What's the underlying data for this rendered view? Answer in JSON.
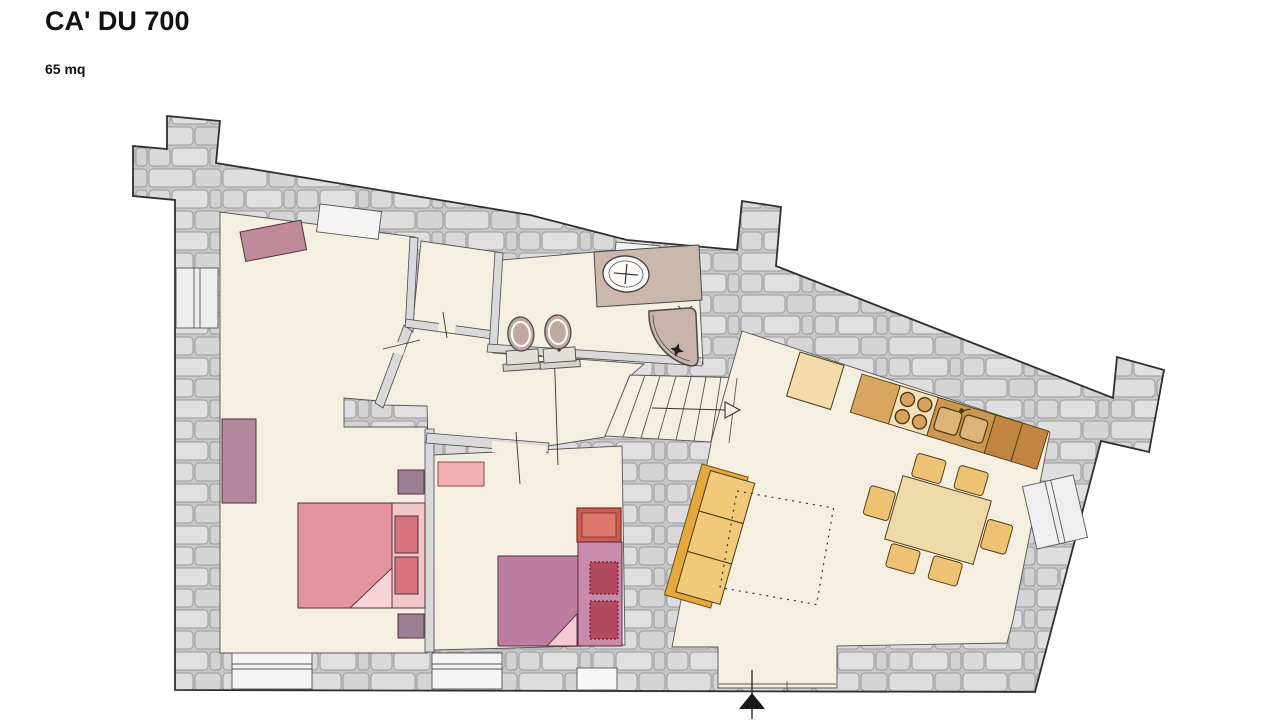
{
  "header": {
    "title": "CA' DU 700",
    "area_label": "65 mq"
  },
  "plan": {
    "rooms": [
      "bedroom-1",
      "closet",
      "bathroom",
      "hallway",
      "stairs",
      "bedroom-2",
      "living-room-kitchen",
      "entrance"
    ],
    "furniture": [
      "double-bed",
      "single-bed-with-trundle",
      "wardrobe",
      "dresser",
      "nightstands",
      "sofa",
      "rug-outline",
      "dining-table-six-chairs",
      "kitchen-counter",
      "stove",
      "double-sink",
      "cabinet",
      "washbasin-vanity",
      "toilet",
      "bidet",
      "corner-shower"
    ],
    "colors": {
      "wall_stone": "#d2d2d2",
      "floor_cream": "#f5efe2",
      "bed_pink": "#e595a0",
      "bed_purple": "#bd7da0",
      "mauve_furniture": "#b4889c",
      "sofa_cushion": "#f2c979",
      "sofa_frame": "#e3a83e",
      "table_tan": "#eedaa9",
      "counter_brown": "#c28441",
      "pillow_red": "#b2485e",
      "entrance_arrow": "#1a1a1a"
    }
  }
}
